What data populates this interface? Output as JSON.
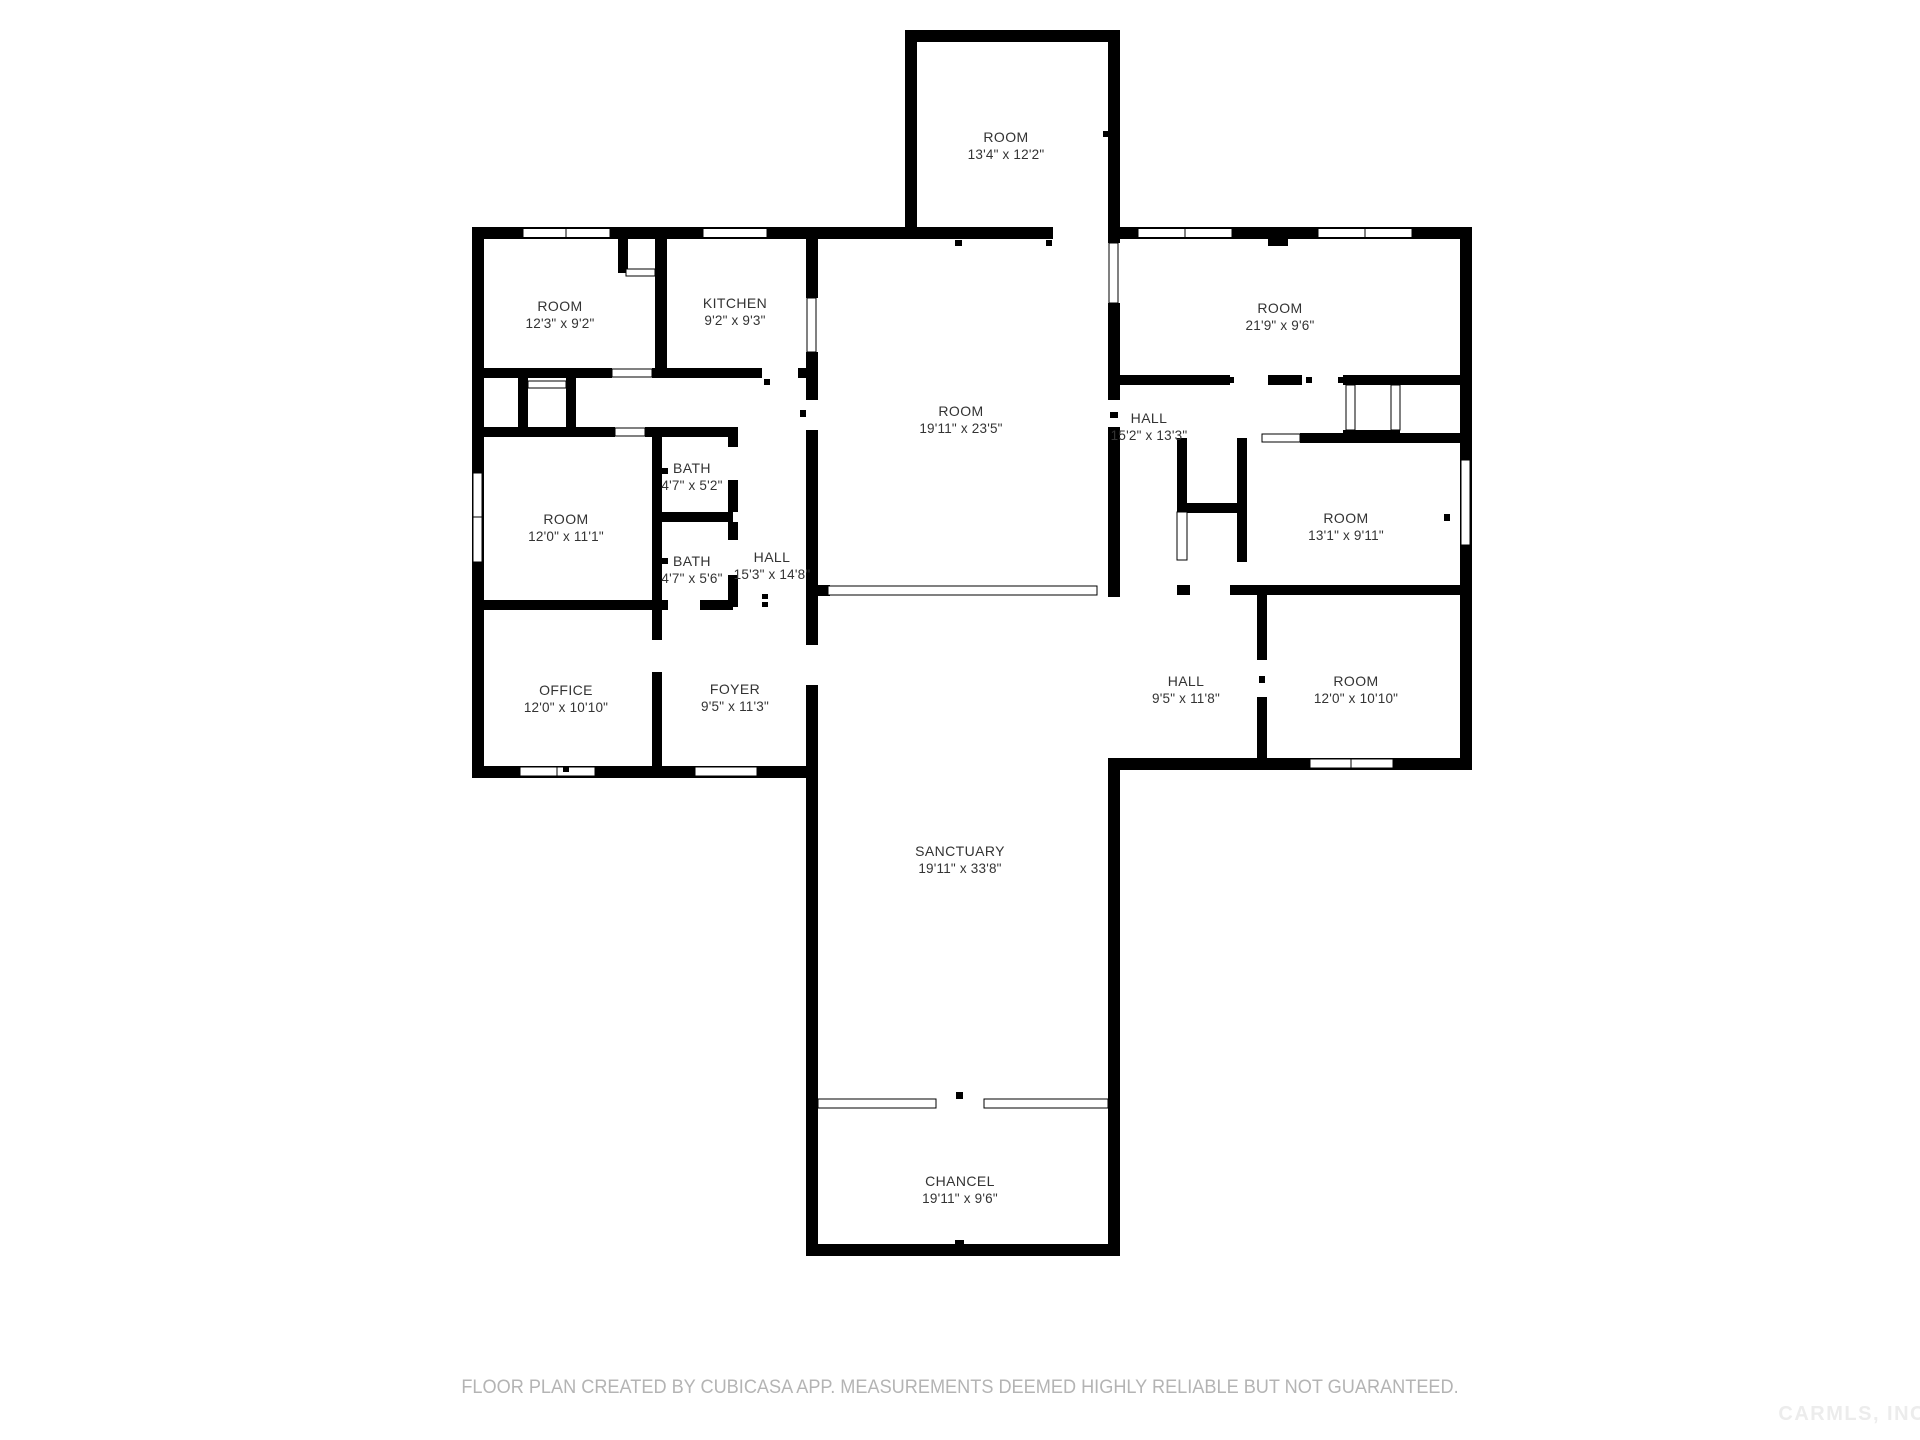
{
  "page": {
    "background_color": "#ffffff",
    "wall_color": "#000000",
    "label_color": "#333333",
    "disclaimer_color": "#b4b4b4"
  },
  "rooms": [
    {
      "name": "ROOM",
      "dims": "13'4\" x 12'2\"",
      "x": 1006,
      "y": 146
    },
    {
      "name": "ROOM",
      "dims": "12'3\" x 9'2\"",
      "x": 560,
      "y": 315
    },
    {
      "name": "KITCHEN",
      "dims": "9'2\" x 9'3\"",
      "x": 735,
      "y": 312
    },
    {
      "name": "ROOM",
      "dims": "12'0\" x 11'1\"",
      "x": 566,
      "y": 528
    },
    {
      "name": "BATH",
      "dims": "4'7\" x 5'2\"",
      "x": 692,
      "y": 477
    },
    {
      "name": "BATH",
      "dims": "4'7\" x 5'6\"",
      "x": 692,
      "y": 570
    },
    {
      "name": "HALL",
      "dims": "15'3\" x 14'8\"",
      "x": 772,
      "y": 566
    },
    {
      "name": "OFFICE",
      "dims": "12'0\" x 10'10\"",
      "x": 566,
      "y": 699
    },
    {
      "name": "FOYER",
      "dims": "9'5\" x 11'3\"",
      "x": 735,
      "y": 698
    },
    {
      "name": "ROOM",
      "dims": "19'11\" x 23'5\"",
      "x": 961,
      "y": 420
    },
    {
      "name": "ROOM",
      "dims": "21'9\" x 9'6\"",
      "x": 1280,
      "y": 317
    },
    {
      "name": "HALL",
      "dims": "15'2\" x 13'3\"",
      "x": 1149,
      "y": 427
    },
    {
      "name": "ROOM",
      "dims": "13'1\" x 9'11\"",
      "x": 1346,
      "y": 527
    },
    {
      "name": "HALL",
      "dims": "9'5\" x 11'8\"",
      "x": 1186,
      "y": 690
    },
    {
      "name": "ROOM",
      "dims": "12'0\" x 10'10\"",
      "x": 1356,
      "y": 690
    },
    {
      "name": "SANCTUARY",
      "dims": "19'11\" x 33'8\"",
      "x": 960,
      "y": 860
    },
    {
      "name": "CHANCEL",
      "dims": "19'11\" x 9'6\"",
      "x": 960,
      "y": 1190
    }
  ],
  "footer": {
    "disclaimer": "FLOOR PLAN CREATED BY CUBICASA APP. MEASUREMENTS DEEMED HIGHLY RELIABLE BUT NOT GUARANTEED.",
    "watermark": "CARMLS, INC"
  }
}
